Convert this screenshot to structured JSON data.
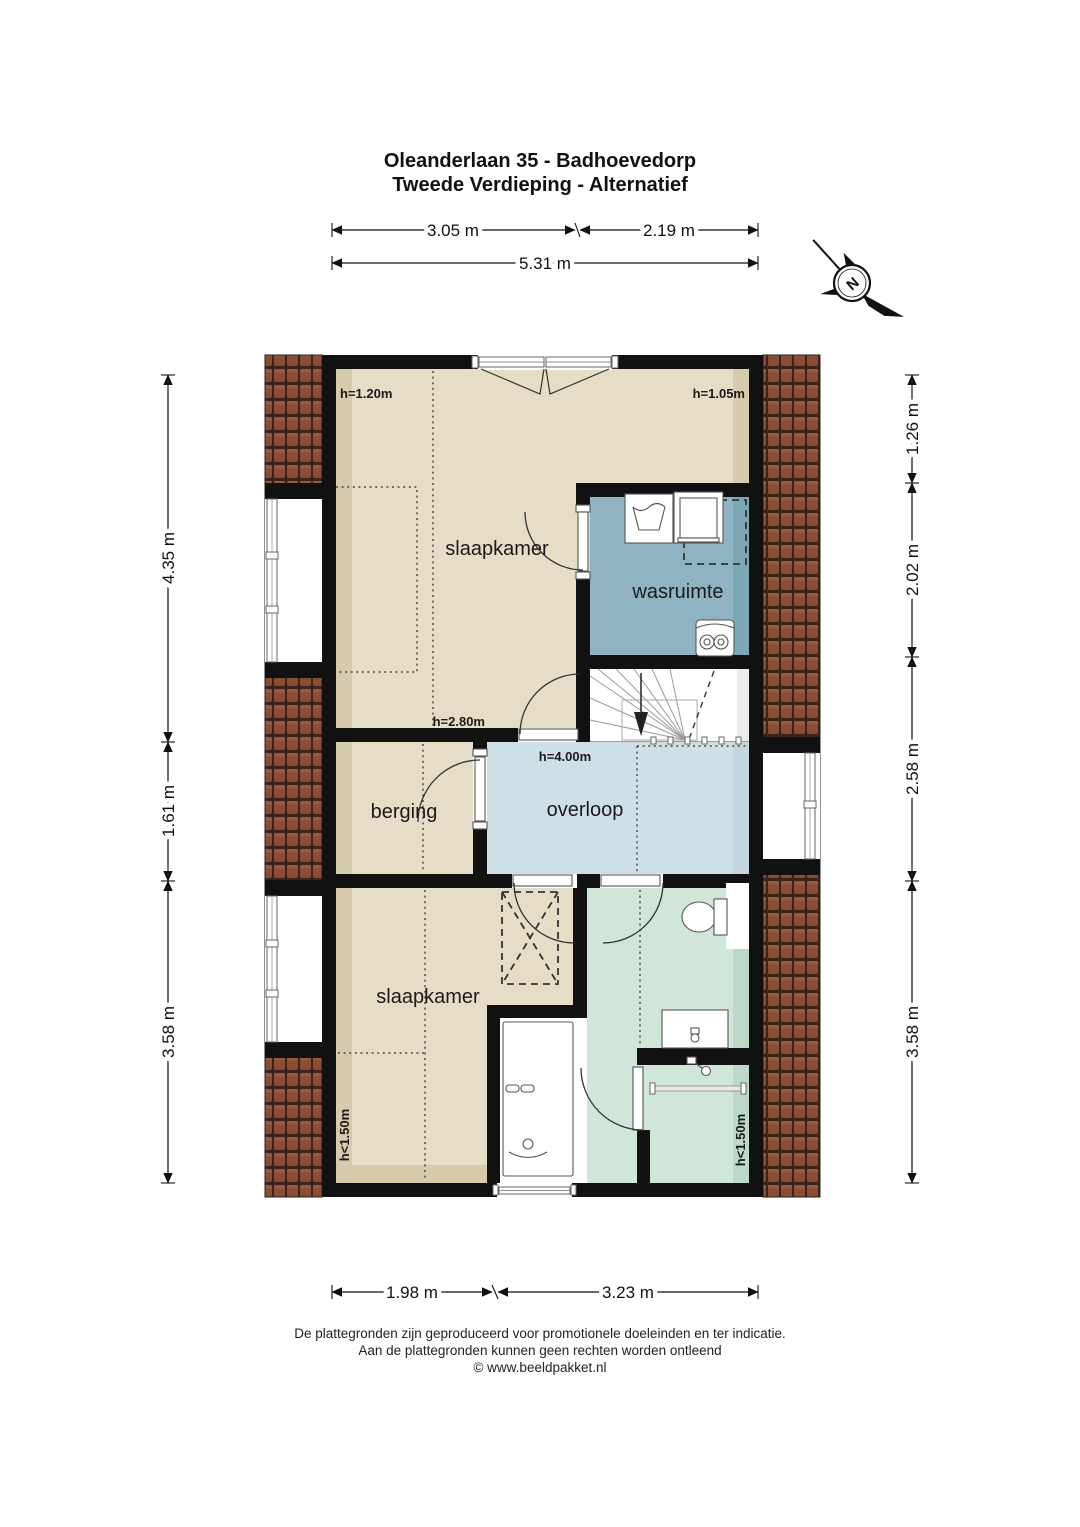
{
  "title": {
    "line1": "Oleanderlaan 35 - Badhoevedorp",
    "line2": "Tweede Verdieping - Alternatief"
  },
  "compass": {
    "north_label": "N"
  },
  "rooms": {
    "slaapkamer_top": {
      "label": "slaapkamer"
    },
    "wasruimte": {
      "label": "wasruimte"
    },
    "berging": {
      "label": "berging"
    },
    "overloop": {
      "label": "overloop"
    },
    "slaapkamer_bottom": {
      "label": "slaapkamer"
    }
  },
  "height_labels": {
    "slaapkamer_top_left": "h=1.20m",
    "slaapkamer_top_right": "h=1.05m",
    "mid_door": "h=2.80m",
    "overloop": "h=4.00m",
    "slaapkamer_bottom": "h<1.50m",
    "badkamer": "h<1.50m"
  },
  "dimensions": {
    "top_row1": [
      {
        "label": "3.05 m"
      },
      {
        "label": "2.19 m"
      }
    ],
    "top_row2": [
      {
        "label": "5.31 m"
      }
    ],
    "bottom": [
      {
        "label": "1.98 m"
      },
      {
        "label": "3.23 m"
      }
    ],
    "left": [
      {
        "label": "4.35 m"
      },
      {
        "label": "1.61 m"
      },
      {
        "label": "3.58 m"
      }
    ],
    "right": [
      {
        "label": "1.26 m"
      },
      {
        "label": "2.02 m"
      },
      {
        "label": "2.58 m"
      },
      {
        "label": "3.58 m"
      }
    ]
  },
  "footer": {
    "line1": "De plattegronden zijn geproduceerd voor promotionele doeleinden en ter indicatie.",
    "line2": "Aan de plattegronden kunnen geen rechten worden ontleend",
    "line3": "© www.beeldpakket.nl"
  },
  "colors": {
    "wall": "#111111",
    "floor_bedroom": "#e6ddc6",
    "floor_bedroom_shade": "#d7cbae",
    "floor_wasruimte": "#8fb3c2",
    "floor_wasruimte_shade": "#7da6b7",
    "floor_overloop": "#cfdfe6",
    "floor_overloop_shade": "#c3d5dd",
    "floor_badkamer": "#cfe6d9",
    "floor_badkamer_shade": "#bcd8c9",
    "roof_tile": "#8a4d33",
    "roof_grout": "#3a241b"
  }
}
